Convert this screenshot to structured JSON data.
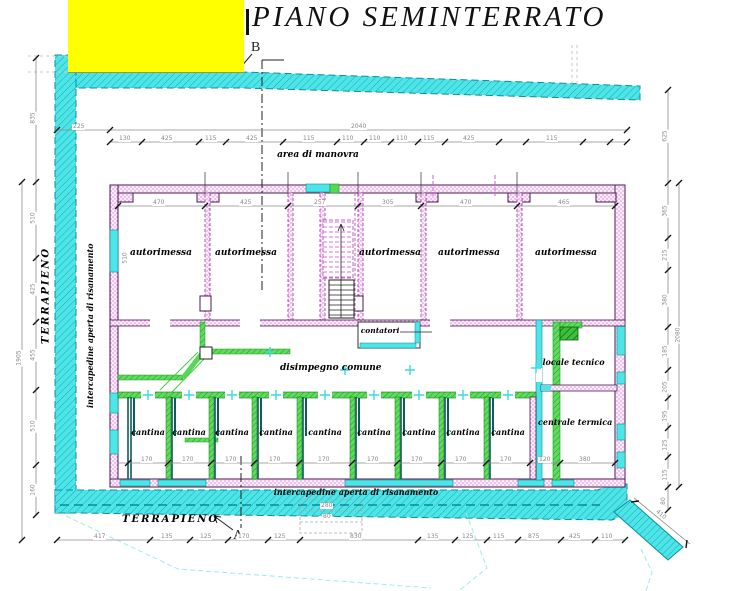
{
  "title": "PIANO SEMINTERRATO",
  "section_markers": {
    "top": "B",
    "bottom": "A"
  },
  "labels": {
    "area_manovra": "area di manovra",
    "terrapieno_left": "TERRAPIENO",
    "terrapieno_bottom": "TERRAPIENO",
    "intercapedine_left": "intercapedine aperta di risanamento",
    "intercapedine_bottom": "intercapedine aperta di risanamento",
    "disimpegno": "disimpegno comune",
    "contatori": "contatori",
    "locale_tecnico": "locale tecnico",
    "centrale_termica": "centrale termica"
  },
  "rooms": {
    "autorimessa": [
      "autorimessa",
      "autorimessa",
      "autorimessa",
      "autorimessa",
      "autorimessa"
    ],
    "cantina": [
      "cantina",
      "cantina",
      "cantina",
      "cantina",
      "cantina",
      "cantina",
      "cantina",
      "cantina",
      "cantina"
    ]
  },
  "colors": {
    "embankment_cyan": "#4EE5E8",
    "wall_magenta": "#C85EC8",
    "new_wall_green": "#55D855",
    "dark_teal": "#0E5C5C",
    "redaction_yellow": "#FFFF00",
    "dimension_gray": "#8a8a8a"
  },
  "dims": {
    "overall_top": "2040",
    "top_left_offset": "225",
    "top_chain": [
      "130",
      "425",
      "115",
      "425",
      "115",
      "110",
      "110",
      "110",
      "115",
      "425",
      "115"
    ],
    "garage_chain": [
      "470",
      "425",
      "257",
      "305",
      "470",
      "465"
    ],
    "garage_depth": "510",
    "cantina_chain": [
      "170",
      "170",
      "170",
      "170",
      "170",
      "170",
      "170",
      "170",
      "170",
      "120",
      "380"
    ],
    "left_outer": "1905",
    "left_chain": [
      "835",
      "510",
      "425",
      "455",
      "510",
      "160"
    ],
    "right_chain": [
      "625",
      "365",
      "215",
      "380",
      "185",
      "205",
      "195",
      "125",
      "115",
      "80"
    ],
    "right_outer": "2080",
    "bottom_chain": [
      "417",
      "135",
      "125",
      "170",
      "125",
      "830",
      "135",
      "125",
      "115",
      "875",
      "425",
      "110"
    ],
    "ramp": "410",
    "parking_note_a": "280",
    "parking_note_b": "80"
  }
}
